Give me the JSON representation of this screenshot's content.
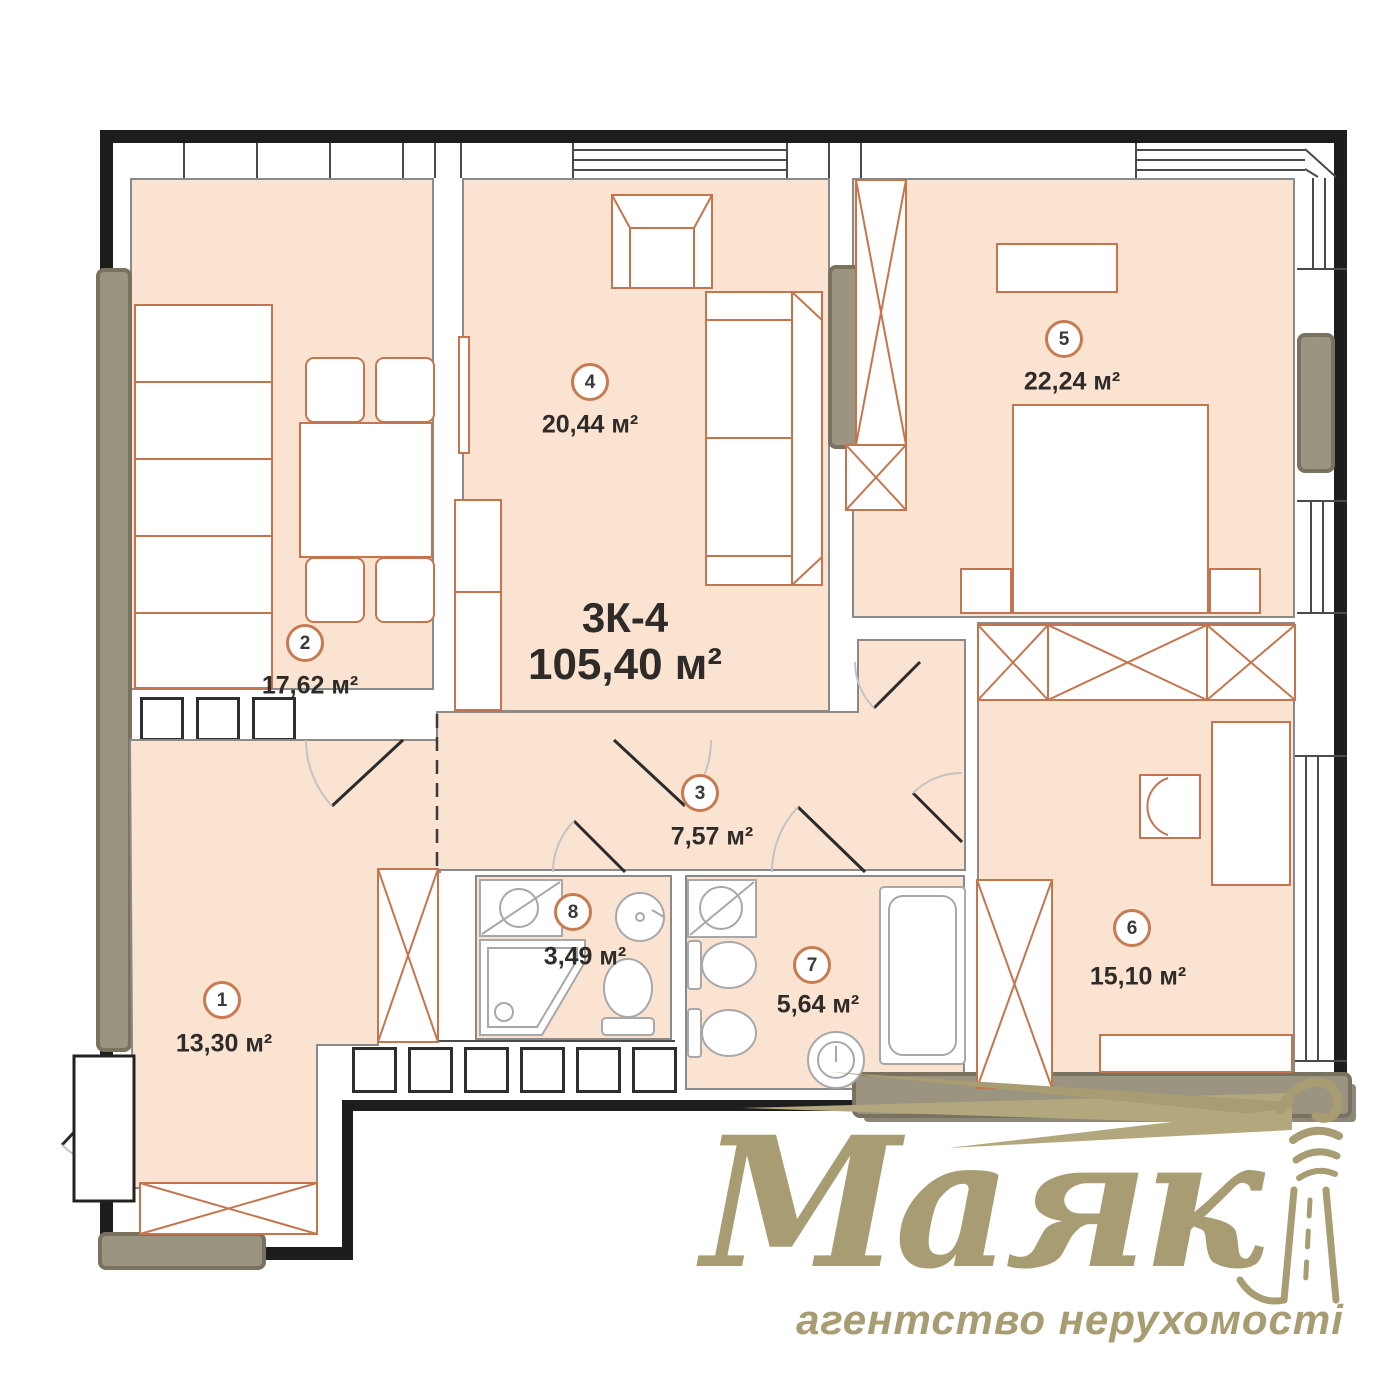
{
  "plan": {
    "code": "3К-4",
    "total_area": "105,40 м²",
    "rooms": [
      {
        "id": "1",
        "area": "13,30 м²"
      },
      {
        "id": "2",
        "area": "17,62 м²"
      },
      {
        "id": "3",
        "area": "7,57 м²"
      },
      {
        "id": "4",
        "area": "20,44 м²"
      },
      {
        "id": "5",
        "area": "22,24 м²"
      },
      {
        "id": "6",
        "area": "15,10 м²"
      },
      {
        "id": "7",
        "area": "5,64 м²"
      },
      {
        "id": "8",
        "area": "3,49 м²"
      }
    ]
  },
  "logo": {
    "brand": "Маяк",
    "tagline": "агентство нерухомості"
  },
  "colors": {
    "room_fill": "#fbe3d2",
    "furniture_outline": "#c4754e",
    "wall": "#1d1d1d",
    "gray_element": "#9a9480",
    "label_circle": "#c87a50",
    "logo": "#a89d72",
    "text": "#2f2b29"
  }
}
